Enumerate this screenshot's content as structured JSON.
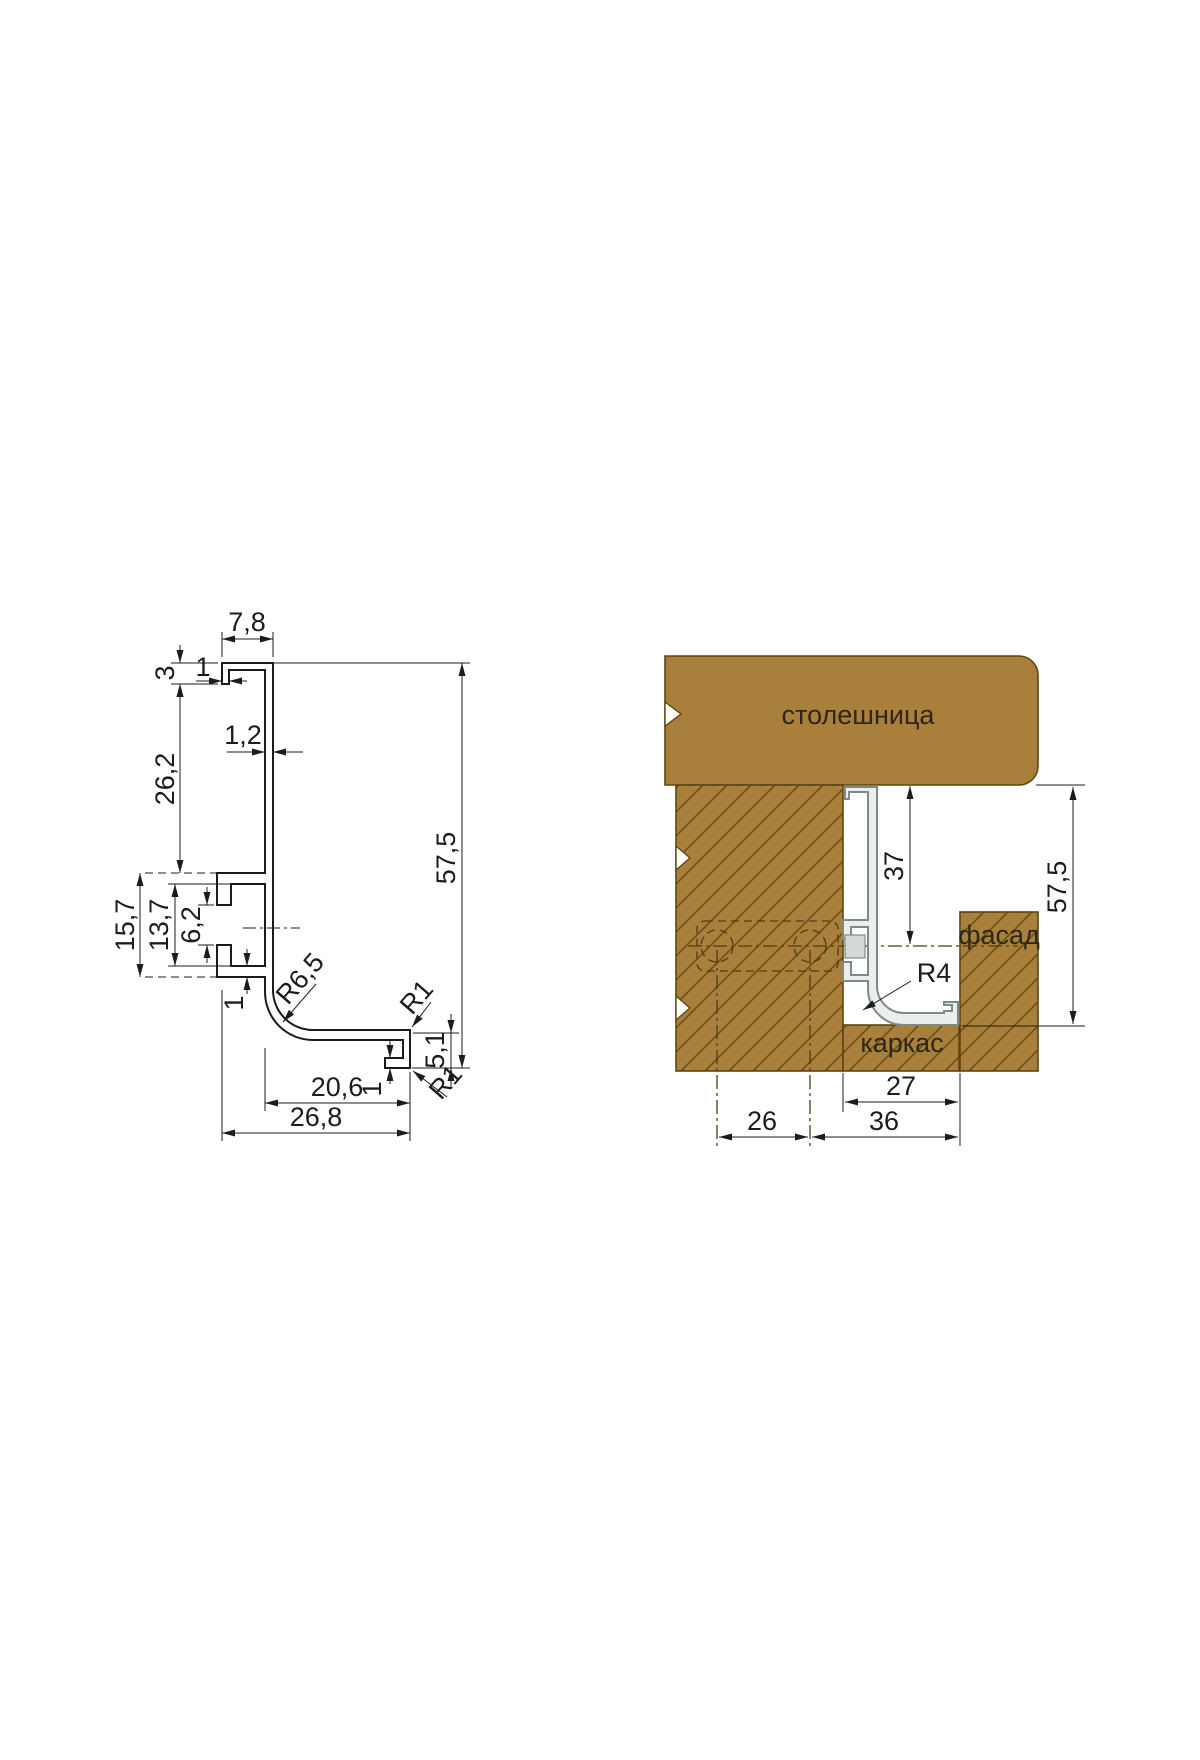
{
  "colors": {
    "wood_fill": "#a9803b",
    "wood_hatch": "#6f5317",
    "wood_outline": "#5e4712",
    "profile_fill": "#eceeec",
    "profile_outline": "#7e8a8a",
    "dimension_line_color": "#1c1c1c"
  },
  "left_drawing": {
    "dims": {
      "top_width": "7,8",
      "top_hook_height": "3",
      "top_hook_thickness": "1",
      "web_thickness": "1,2",
      "upper_height": "26,2",
      "clip_outer_height": "15,7",
      "clip_inner_height": "13,7",
      "clip_opening": "6,2",
      "clip_wall": "1",
      "inner_radius": "R6,5",
      "leg_corner_radius": "R1",
      "front_lip_height": "5,1",
      "lip_hook": "1",
      "leg_length": "20,6",
      "overall_width": "26,8",
      "lip_corner_radius": "R1",
      "overall_height": "57,5"
    }
  },
  "right_drawing": {
    "labels": {
      "countertop": "столешница",
      "facade": "фасад",
      "carcass": "каркас"
    },
    "dims": {
      "profile_drop": "37",
      "overall_height": "57,5",
      "outer_radius": "R4",
      "carcass_depth": "27",
      "screw_spacing": "26",
      "facade_offset": "36"
    }
  }
}
